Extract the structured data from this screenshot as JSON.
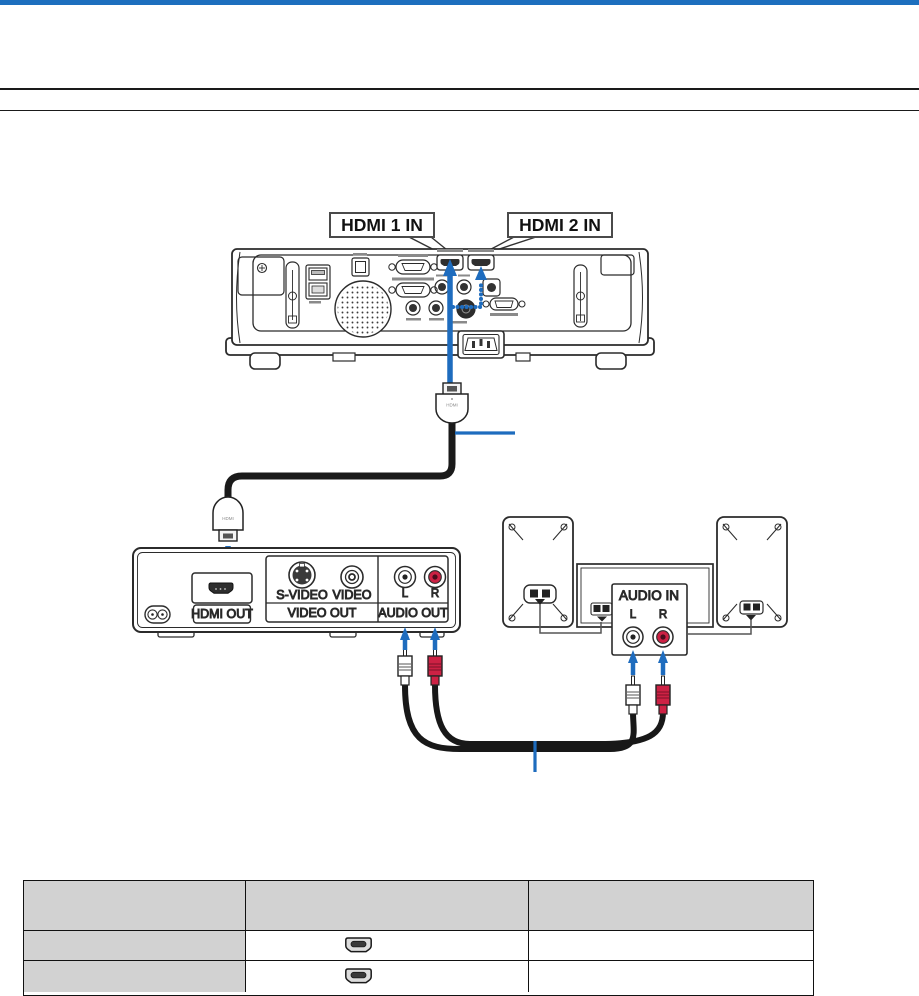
{
  "header": {
    "top_bar_color": "#1d6fbe"
  },
  "callouts": {
    "hdmi1_label": "HDMI 1 IN",
    "hdmi2_label": "HDMI 2 IN"
  },
  "hdmi_cable": {
    "plug_top_label": "HDMI",
    "plug_bottom_label": "HDMI"
  },
  "dvd_player": {
    "hdmi_out_label": "HDMI OUT",
    "s_video_label": "S-VIDEO",
    "video_label": "VIDEO",
    "video_out_label": "VIDEO OUT",
    "left_label": "L",
    "right_label": "R",
    "audio_out_label": "AUDIO OUT"
  },
  "audio_equipment": {
    "audio_in_label": "AUDIO IN",
    "left_label": "L",
    "right_label": "R"
  },
  "connection_table": {
    "columns": [
      "",
      "",
      ""
    ],
    "rows": [
      {
        "left": "",
        "connector_icon": "hdmi-connector-icon",
        "right": ""
      },
      {
        "left": "",
        "connector_icon": "hdmi-connector-icon",
        "right": ""
      }
    ],
    "header_fill": "#d2d2d2"
  },
  "colors": {
    "accent_blue": "#1e6cbe",
    "rca_red": "#cd2144",
    "line_art": "#2b2b2b"
  }
}
